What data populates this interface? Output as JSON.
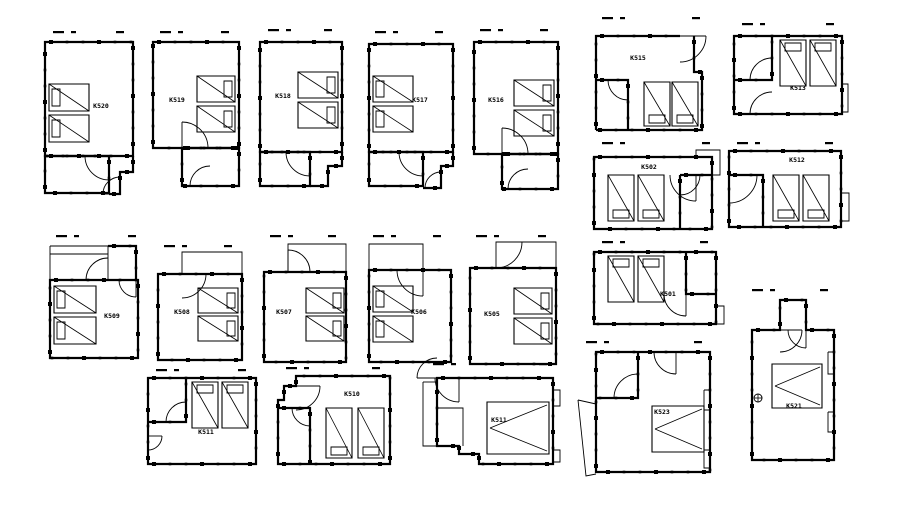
{
  "sheet": {
    "kind": "architectural-floor-plan-sheet",
    "room_count": 20
  },
  "colors": {
    "ink": "#000000",
    "paper": "#ffffff"
  },
  "rooms": [
    {
      "label": "K520"
    },
    {
      "label": "K519"
    },
    {
      "label": "K518"
    },
    {
      "label": "K517"
    },
    {
      "label": "K516"
    },
    {
      "label": "K515"
    },
    {
      "label": "K513"
    },
    {
      "label": "K502"
    },
    {
      "label": "K512"
    },
    {
      "label": "K509"
    },
    {
      "label": "K508"
    },
    {
      "label": "K507"
    },
    {
      "label": "K506"
    },
    {
      "label": "K505"
    },
    {
      "label": "K501"
    },
    {
      "label": "K511"
    },
    {
      "label": "K510"
    },
    {
      "label": "K511"
    },
    {
      "label": "K523"
    },
    {
      "label": "K521"
    }
  ]
}
